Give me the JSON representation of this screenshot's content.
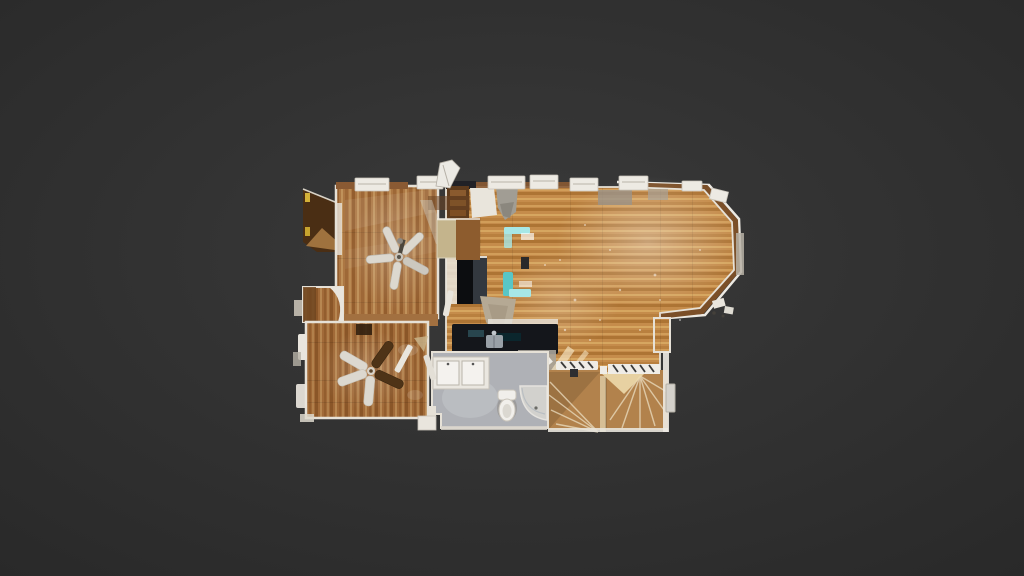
{
  "viewer": {
    "type": "3d-model-viewer",
    "view_mode": "top-down-orthographic",
    "content": "residential-floorplan-scan",
    "visible_text": "none"
  },
  "scene": {
    "description": "Photogrammetry dollhouse top-down view of a single-story home floating on a dark gray viewer background",
    "ceiling_fans": 2,
    "rooms": [
      {
        "id": "bedroom-upper-left",
        "features": [
          "ceiling-fan",
          "vertical-plank-wood-floor",
          "entry-wedge"
        ]
      },
      {
        "id": "great-room",
        "features": [
          "octagonal-bay-window",
          "horizontal-plank-wood-floor",
          "teal-chairs",
          "bookshelf"
        ]
      },
      {
        "id": "kitchen",
        "features": [
          "black-counters",
          "refrigerator",
          "steel-sink"
        ]
      },
      {
        "id": "bedroom-lower-left",
        "features": [
          "ceiling-fan",
          "wood-floor",
          "closet-doors",
          "dark-mat"
        ]
      },
      {
        "id": "bathroom",
        "features": [
          "double-sink-vanity",
          "toilet",
          "corner-shower",
          "gray-tile-floor"
        ]
      },
      {
        "id": "staircase",
        "features": [
          "winder-treads",
          "white-railing",
          "center-stringer"
        ]
      }
    ]
  },
  "colors": {
    "bg_center": "#3a3a3a",
    "bg_edge": "#292929",
    "wall_white": "#e6e1d7",
    "wall_wood": "#8a5a33",
    "bay_cap": "#7b4f28",
    "entry_dark": "#4a2e14",
    "entry_light": "#a87a42",
    "wood_a_base": "#ac7743",
    "wood_a_dark": "#945e2e",
    "wood_a_light": "#c3975f",
    "wood_b_base": "#c58c4b",
    "wood_b_dark": "#ad7434",
    "wood_b_light": "#d9a963",
    "wood_c_base": "#a16a38",
    "wood_c_dark": "#8a5628",
    "wood_c_light": "#bd8f58",
    "accent_teal": "#a7e7e6",
    "teal_deep": "#58c6c6",
    "counter_dark": "#14161b",
    "fridge_black": "#0c0d10",
    "appliance_gray": "#373d45",
    "steel_sink": "#99a0a7",
    "artifact_white": "#edeae3",
    "artifact_gray": "#b7b1a6",
    "bath_floor": "#afb1b6",
    "bath_floor_light": "#c2c4c8",
    "porcelain": "#f1efeb",
    "shower_glass": "#d9d7d2",
    "stairs_base": "#b2824c",
    "stairs_light": "#ecd9ac",
    "sun_streak": "#f3e3c0",
    "fan_blade_light": "#dcd8cf",
    "fan_blade_dark": "#4e3317",
    "fan_hub": "#c9c4ba",
    "mat_dark": "#32200f",
    "blob_tan": "#b5a994",
    "fireplace_beige": "#c4b48c",
    "shelf_brown": "#5e3b1d",
    "yellow_speck": "#d4b138"
  }
}
